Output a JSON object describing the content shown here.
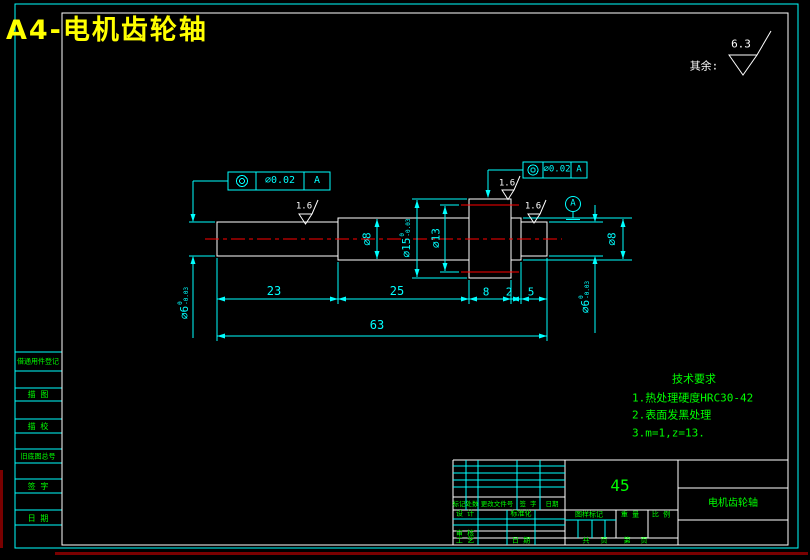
{
  "title": "A4-电机齿轮轴",
  "surface_default": {
    "label": "其余:",
    "value": "6.3"
  },
  "frames": [
    {
      "symbol": "concentricity",
      "value": "⌀0.02",
      "datum": "A"
    },
    {
      "symbol": "concentricity",
      "value": "⌀0.02",
      "datum": "A"
    }
  ],
  "datum_flag": "A",
  "roughness": [
    "1.6",
    "1.6",
    "1.6"
  ],
  "dims": {
    "linear": {
      "d23": "23",
      "d25": "25",
      "d8": "8",
      "d2": "2",
      "d5": "5",
      "d63": "63"
    },
    "dia6_left": {
      "text": "⌀6",
      "up": "0",
      "low": "-0.03"
    },
    "dia8_mid": "⌀8",
    "dia15": {
      "text": "⌀15",
      "up": "0",
      "low": "-0.03"
    },
    "dia13": "⌀13",
    "dia8_right": "⌀8",
    "dia6_right": {
      "text": "⌀6",
      "up": "0",
      "low": "-0.03"
    }
  },
  "tech_req": {
    "title": "技术要求",
    "items": [
      "1.热处理硬度HRC30-42",
      "2.表面发黑处理",
      "3.m=1,z=13."
    ]
  },
  "side_column": [
    "借通用件登记",
    "描 图",
    "描 校",
    "旧底图总号",
    "签 字",
    "日 期"
  ],
  "title_block": {
    "material": "45",
    "part_name": "电机齿轮轴",
    "mark": "标记",
    "count": "处数",
    "change_doc": "更改文件号",
    "sign": "签 字",
    "date": "日期",
    "design": "设 计",
    "standard": "标准化",
    "review": "审 核",
    "process": "工 艺",
    "date2": "日 期",
    "drawing_mark": "图样标记",
    "weight": "重 量",
    "scale": "比 例",
    "total": "共",
    "sheet": "页",
    "no": "第",
    "sheet2": "页"
  },
  "colors": {
    "dim": "#00ffff",
    "outline": "#ffffff",
    "center": "#ff0000",
    "note": "#00ff00",
    "title": "#ffff00",
    "artifact": "#7a0000"
  }
}
